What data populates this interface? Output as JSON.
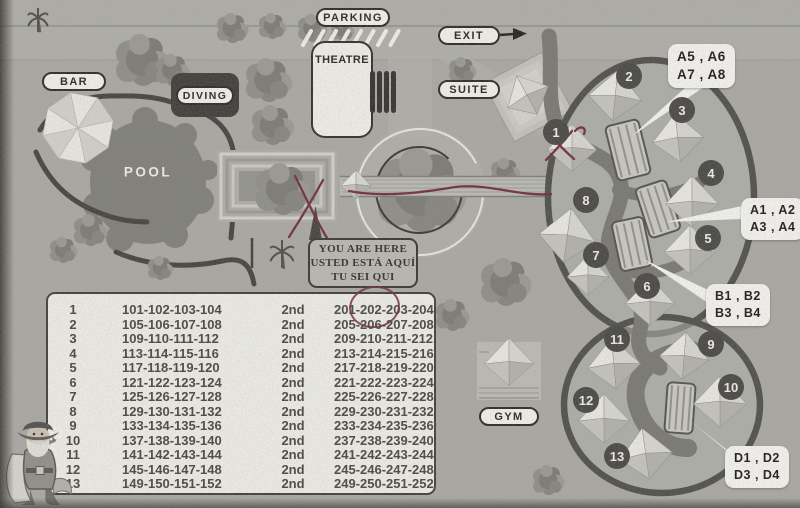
{
  "map": {
    "labels": {
      "bar": "BAR",
      "parking": "PARKING",
      "theatre": "THEATRE",
      "diving": "DIVING",
      "exit": "EXIT",
      "suite": "SUITE",
      "pool": "POOL",
      "gym": "GYM"
    },
    "you_are_here": {
      "line1": "YOU ARE HERE",
      "line2": "USTED ESTÁ AQUÍ",
      "line3": "TU SEI QUI"
    },
    "callouts": [
      {
        "lines": [
          "A5 , A6",
          "A7 , A8"
        ]
      },
      {
        "lines": [
          "A1 , A2",
          "A3 , A4"
        ]
      },
      {
        "lines": [
          "B1 , B2",
          "B3 , B4"
        ]
      },
      {
        "lines": [
          "D1 , D2",
          "D3 , D4"
        ]
      }
    ],
    "hut_numbers": [
      "1",
      "2",
      "3",
      "4",
      "5",
      "6",
      "7",
      "8",
      "9",
      "10",
      "11",
      "12",
      "13"
    ],
    "colors": {
      "annotation_red": "#6f2b33",
      "path_dark": "#77766f",
      "ring_dark": "#4c4b48",
      "label_ink": "#23221f",
      "paper": "#f4f3ee",
      "background": "#a9a8a2"
    }
  },
  "room_table": {
    "rows": [
      {
        "hut": "1",
        "first_floor": "101-102-103-104",
        "floor": "2nd",
        "second_floor": "201-202-203-204"
      },
      {
        "hut": "2",
        "first_floor": "105-106-107-108",
        "floor": "2nd",
        "second_floor": "205-206-207-208"
      },
      {
        "hut": "3",
        "first_floor": "109-110-111-112",
        "floor": "2nd",
        "second_floor": "209-210-211-212"
      },
      {
        "hut": "4",
        "first_floor": "113-114-115-116",
        "floor": "2nd",
        "second_floor": "213-214-215-216"
      },
      {
        "hut": "5",
        "first_floor": "117-118-119-120",
        "floor": "2nd",
        "second_floor": "217-218-219-220"
      },
      {
        "hut": "6",
        "first_floor": "121-122-123-124",
        "floor": "2nd",
        "second_floor": "221-222-223-224"
      },
      {
        "hut": "7",
        "first_floor": "125-126-127-128",
        "floor": "2nd",
        "second_floor": "225-226-227-228"
      },
      {
        "hut": "8",
        "first_floor": "129-130-131-132",
        "floor": "2nd",
        "second_floor": "229-230-231-232"
      },
      {
        "hut": "9",
        "first_floor": "133-134-135-136",
        "floor": "2nd",
        "second_floor": "233-234-235-236"
      },
      {
        "hut": "10",
        "first_floor": "137-138-139-140",
        "floor": "2nd",
        "second_floor": "237-238-239-240"
      },
      {
        "hut": "11",
        "first_floor": "141-142-143-144",
        "floor": "2nd",
        "second_floor": "241-242-243-244"
      },
      {
        "hut": "12",
        "first_floor": "145-146-147-148",
        "floor": "2nd",
        "second_floor": "245-246-247-248"
      },
      {
        "hut": "13",
        "first_floor": "149-150-151-152",
        "floor": "2nd",
        "second_floor": "249-250-251-252"
      }
    ]
  }
}
